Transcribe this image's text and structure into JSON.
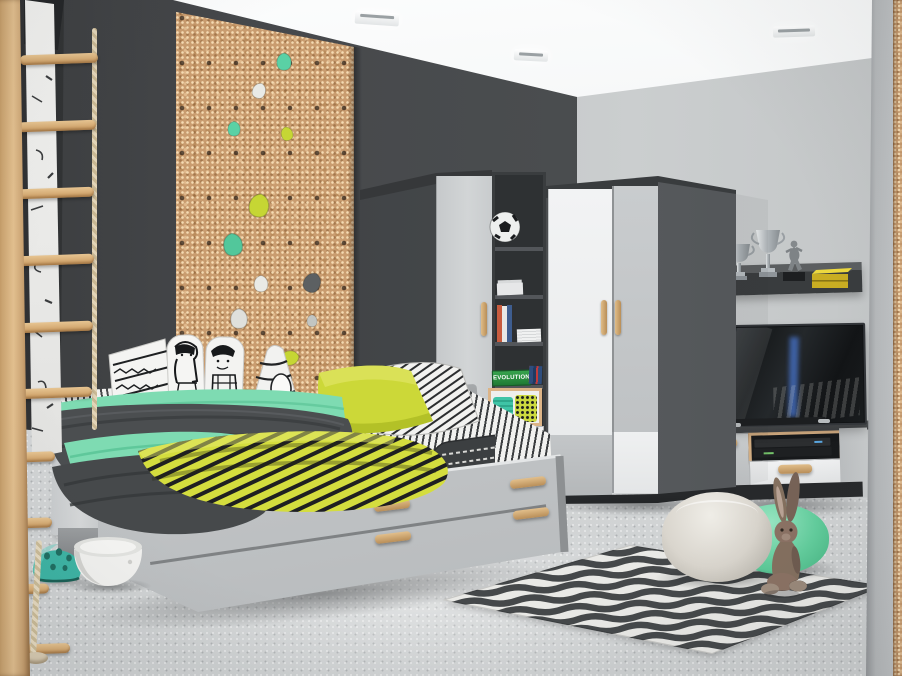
{
  "scene": {
    "type": "3D rendered kids bedroom furniture scene",
    "text": {
      "game_box_label": "EVOLUTION"
    },
    "palette": {
      "ceiling": "#f2f4f5",
      "wall_dark": "#47494b",
      "wall_light": "#c5c8c9",
      "floor": "#d2d4d5",
      "cork": "#c99c6f",
      "wood_accent": "#d3ab7a",
      "furniture_dark_gray": "#4e5154",
      "furniture_light_gray": "#c8cbcd",
      "furniture_white": "#eef0f1",
      "mint_green": "#7edbb2",
      "teal": "#3cbfa0",
      "chartreuse_yellow": "#ccd838",
      "rug_dark_gray": "#45484a",
      "rug_off_white": "#e8e8e5",
      "trophy_silver": "#c9cdd0",
      "box_yellow": "#d8c22e"
    },
    "objects": [
      "wooden wall ladder with rope and wooden rungs",
      "white doodle banner behind ladder",
      "cork climbing wall panel with pastel climbing holds",
      "three recessed ceiling lights",
      "single bed with two trundle drawers and wooden handles",
      "doodle character pillows (girl, boy, aztec, letter-A)",
      "chartreuse yellow pillow",
      "black and white striped bedding",
      "mint green blanket",
      "yellow and black striped blanket",
      "dark gray striped bolster",
      "tall wardrobe with light gray door",
      "open shelf column with soccer ball, books and baskets",
      "green EVOLUTION game box",
      "two-tone corner wardrobe with wooden handles",
      "wall shelf with two silver trophies, footballer figurine and yellow box",
      "flat screen TV on low TV cabinet with AV receivers",
      "gray zigzag rug",
      "beige knitted pouf",
      "mint green pouf",
      "plush bunny toy",
      "teal toy helmet",
      "white rocking bowl toy"
    ]
  }
}
